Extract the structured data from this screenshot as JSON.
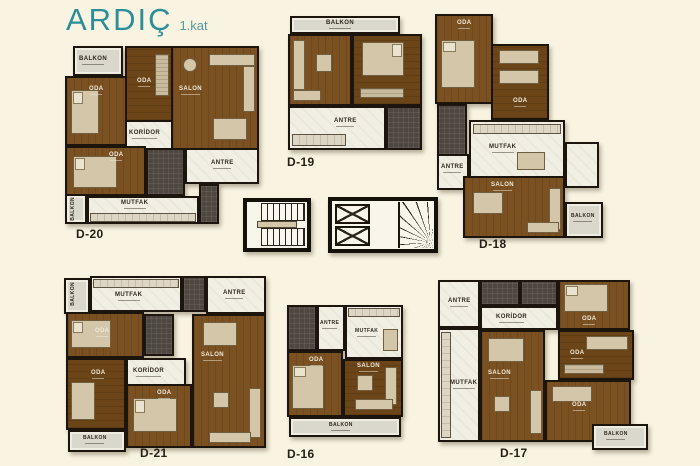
{
  "title": {
    "name": "ARDIÇ",
    "floor": "1.kat"
  },
  "colors": {
    "background": "#f9f4e2",
    "accent_teal": "#2d8e99",
    "wall": "#1c150d",
    "wood_floor": "#7b5122",
    "wood_floor_dark": "#6b4517",
    "tile_floor": "#f1eee3",
    "bathroom": "#4d4740",
    "balcony": "#dad7cc",
    "furniture": "#d3c6a9"
  },
  "plans": {
    "d20": {
      "label": "D-20",
      "rooms": {
        "balkon_top": "BALKON",
        "oda_left": "ODA",
        "oda_mid": "ODA",
        "salon": "SALON",
        "koridor": "KORİDOR",
        "antre": "ANTRE",
        "oda_bottom": "ODA",
        "mutfak": "MUTFAK",
        "balkon_side": "BALKON"
      }
    },
    "d19": {
      "label": "D-19",
      "rooms": {
        "balkon": "BALKON",
        "antre": "ANTRE"
      }
    },
    "d18": {
      "label": "D-18",
      "rooms": {
        "oda_top": "ODA",
        "oda_right": "ODA",
        "antre": "ANTRE",
        "mutfak": "MUTFAK",
        "salon": "SALON",
        "balkon": "BALKON"
      }
    },
    "d21": {
      "label": "D-21",
      "rooms": {
        "balkon_side": "BALKON",
        "mutfak": "MUTFAK",
        "antre": "ANTRE",
        "oda_upper": "ODA",
        "oda_lower": "ODA",
        "koridor": "KORİDOR",
        "oda_bottom": "ODA",
        "salon": "SALON",
        "balkon_bottom": "BALKON"
      }
    },
    "d16": {
      "label": "D-16",
      "rooms": {
        "antre": "ANTRE",
        "mutfak": "MUTFAK",
        "oda": "ODA",
        "salon": "SALON",
        "balkon": "BALKON"
      }
    },
    "d17": {
      "label": "D-17",
      "rooms": {
        "antre": "ANTRE",
        "koridor": "KORİDOR",
        "mutfak": "MUTFAK",
        "oda_1": "ODA",
        "oda_2": "ODA",
        "oda_3": "ODA",
        "salon": "SALON",
        "balkon": "BALKON"
      }
    }
  }
}
